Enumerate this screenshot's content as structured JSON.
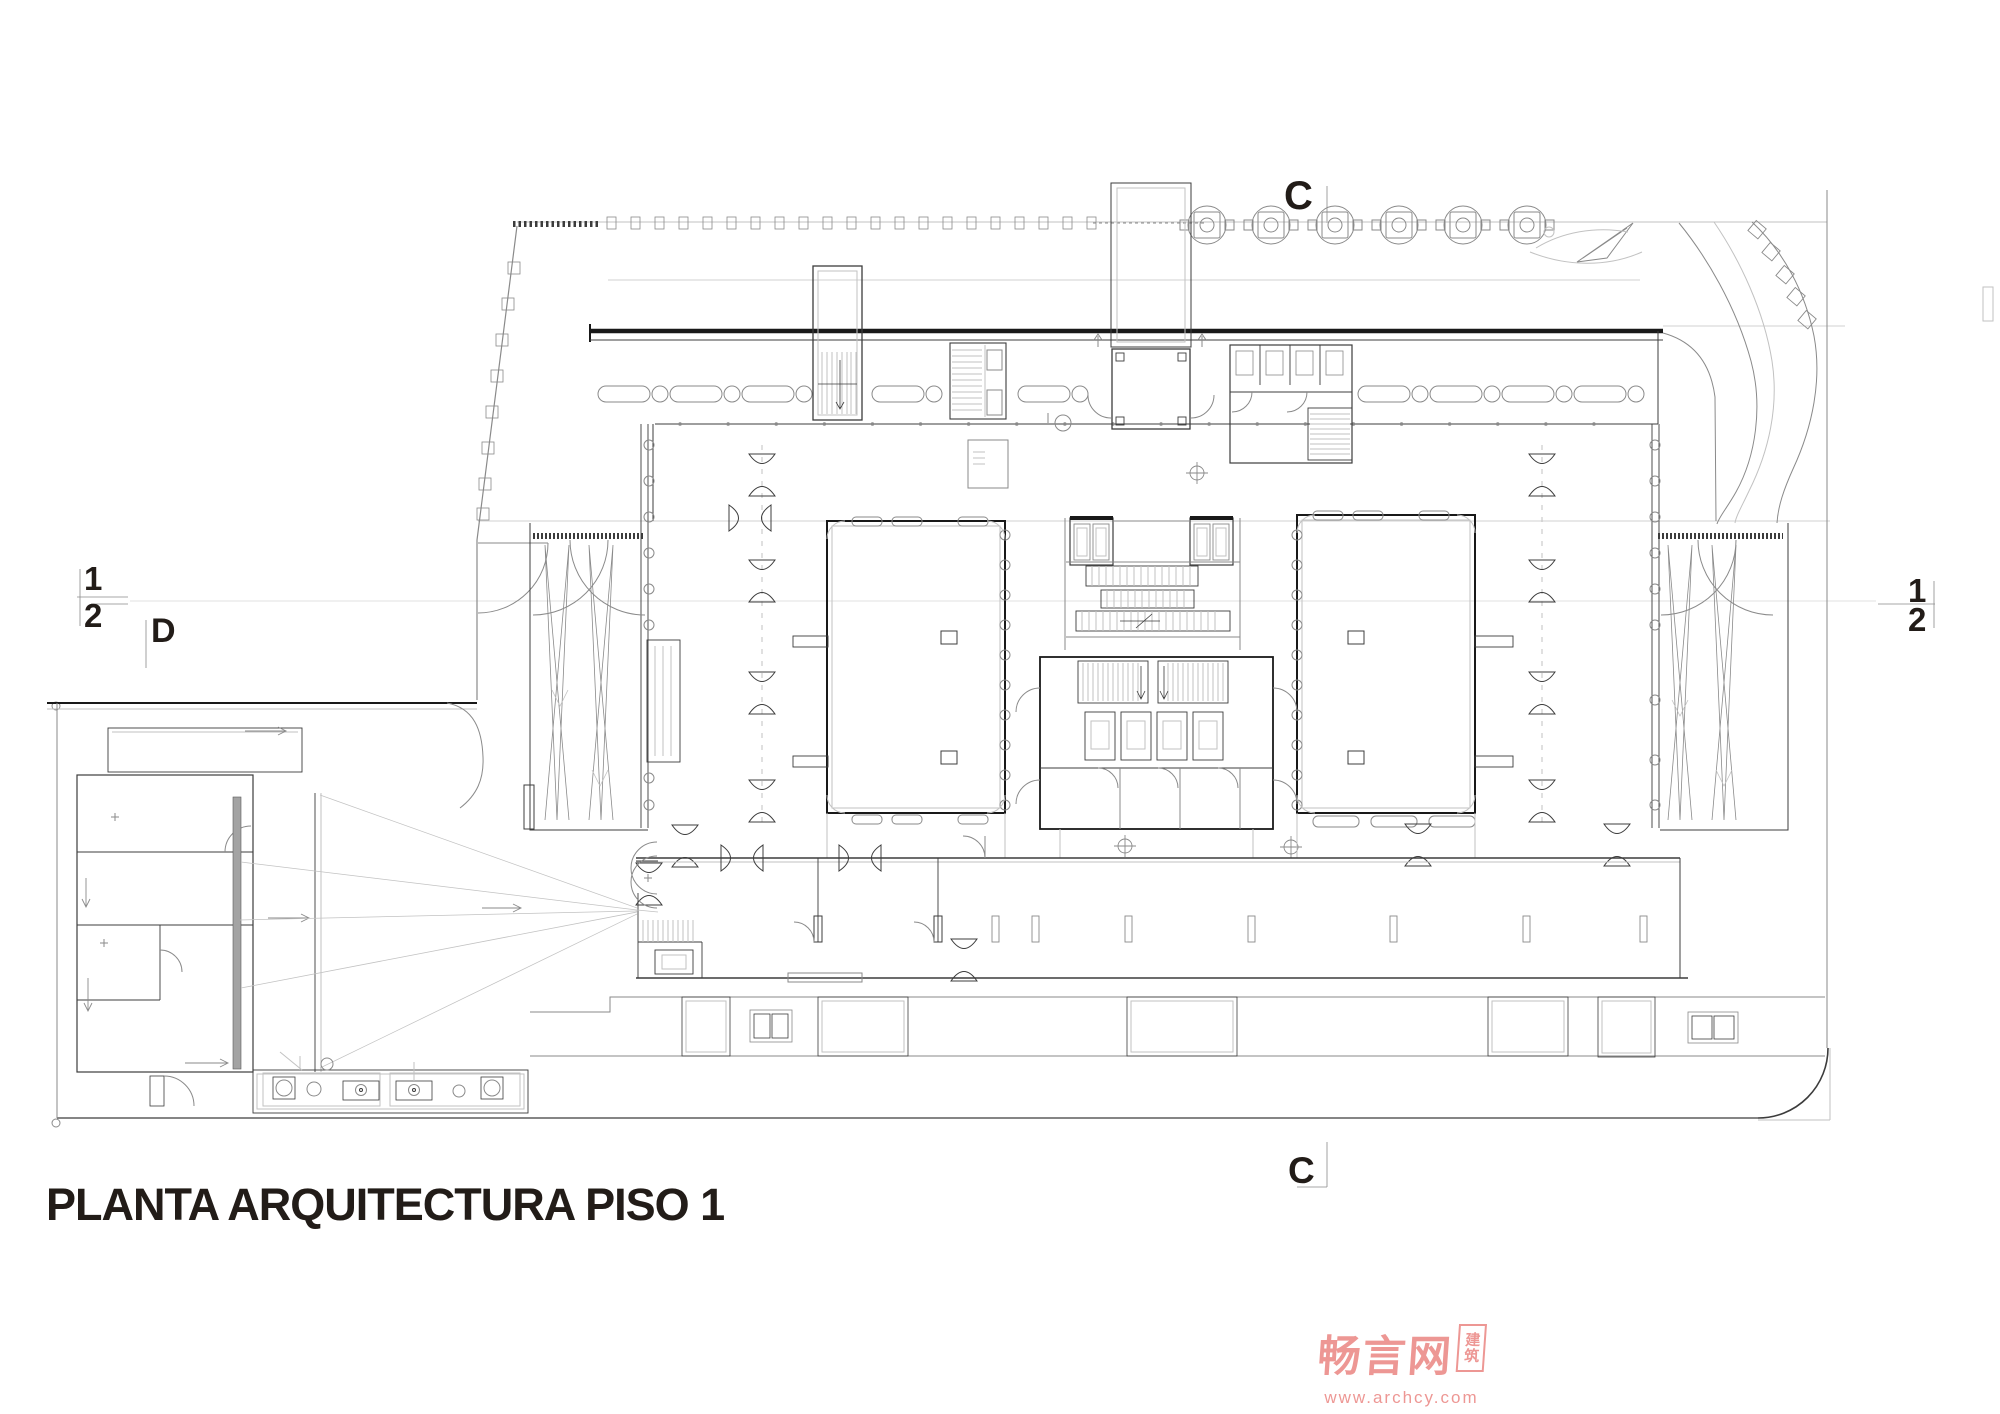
{
  "title": {
    "text": "PLANTA ARQUITECTURA PISO 1"
  },
  "section_markers": {
    "c_top": "C",
    "c_bottom": "C",
    "grid_label_d": "D",
    "left_fraction": {
      "top": "1",
      "bottom": "2"
    },
    "right_fraction": {
      "top": "1",
      "bottom": "2"
    }
  },
  "watermark": {
    "brand": "畅言网",
    "badge": "建筑",
    "url": "www.archcy.com"
  },
  "drawing_meta": {
    "type": "architectural floor plan, first floor (line drawing)"
  },
  "colors": {
    "ink": "#3c3c3c",
    "wall": "#191919",
    "light": "#8a8a8a",
    "faint": "#c2c2c2",
    "label": "#221c18",
    "watermark": "#ec8f8c",
    "bg": "#ffffff"
  }
}
